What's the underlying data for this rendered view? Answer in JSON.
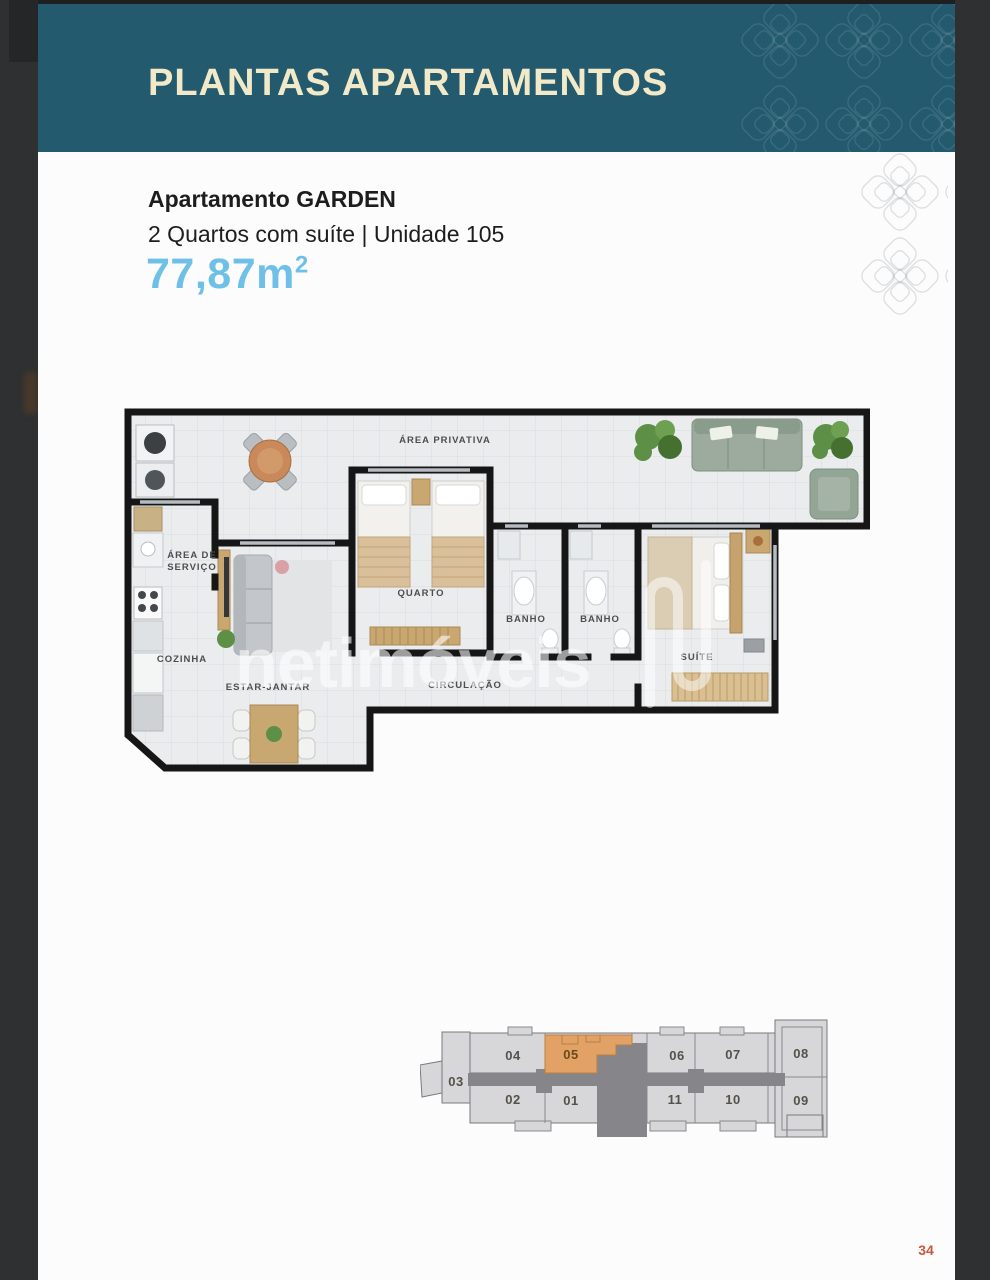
{
  "header": {
    "title": "PLANTAS APARTAMENTOS"
  },
  "apartment": {
    "name": "Apartamento GARDEN",
    "specs": "2 Quartos com suíte | Unidade 105",
    "area_value": "77,87m",
    "area_superscript": "2"
  },
  "floor_plan": {
    "watermark": "netimóveis",
    "labels": {
      "area_privativa": "ÁREA PRIVATIVA",
      "area_de": "ÁREA DE",
      "servico": "SERVIÇO",
      "cozinha": "COZINHA",
      "estar_jantar": "ESTAR-JANTAR",
      "quarto": "QUARTO",
      "banho_1": "BANHO",
      "banho_2": "BANHO",
      "circulacao": "CIRCULAÇÃO",
      "suite": "SUÍTE"
    }
  },
  "key_plan": {
    "highlighted_unit": "05",
    "units": {
      "u03": "03",
      "u04": "04",
      "u05": "05",
      "u06": "06",
      "u07": "07",
      "u08": "08",
      "u02": "02",
      "u01": "01",
      "u11": "11",
      "u10": "10",
      "u09": "09"
    }
  },
  "page": {
    "number": "34"
  },
  "colors": {
    "header_teal": "#235a6e",
    "title_cream": "#f2e9c8",
    "area_blue": "#6fc0e6",
    "page_number_orange": "#c9583a",
    "unit_highlight_orange": "#e2a165"
  }
}
